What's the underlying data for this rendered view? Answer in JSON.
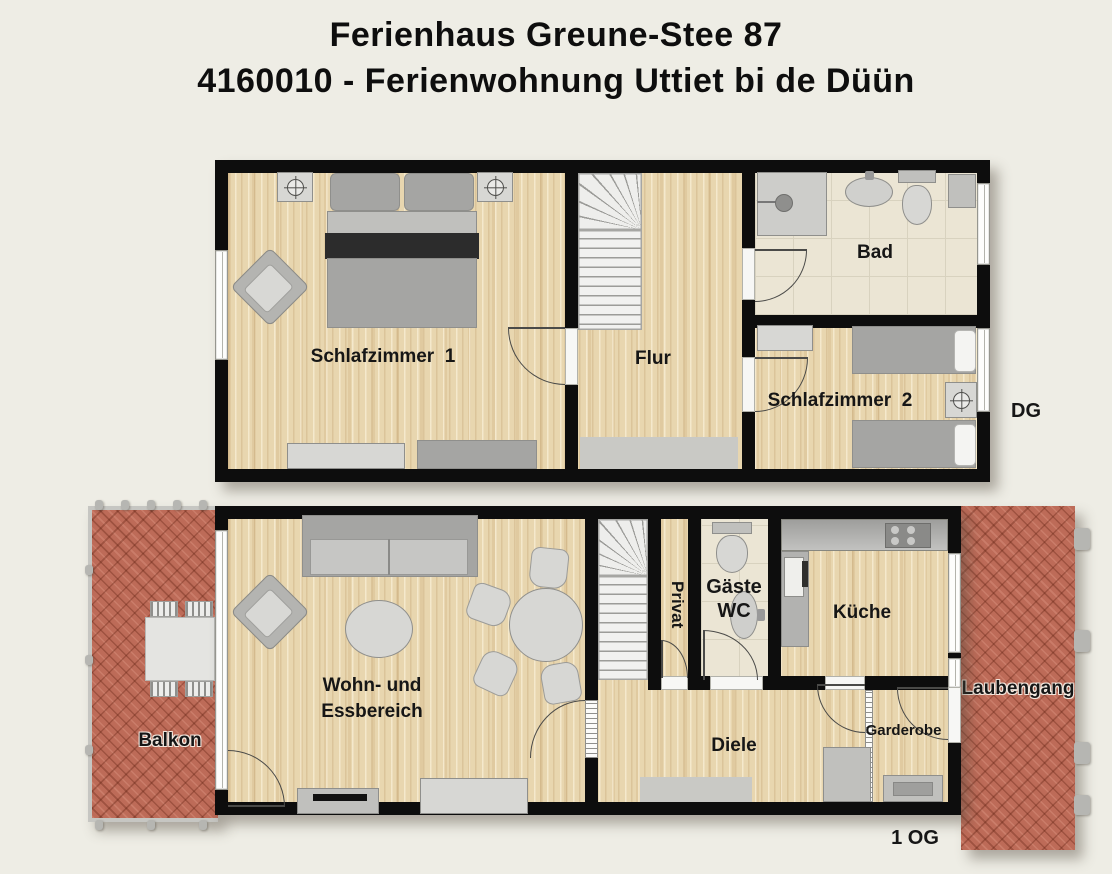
{
  "header": {
    "line1": "Ferienhaus Greune-Stee 87",
    "line2": "4160010 - Ferienwohnung Uttiet bi de Düün"
  },
  "floors": {
    "dg": {
      "tag": "DG",
      "rooms": {
        "schlafzimmer1": "Schlafzimmer  1",
        "flur": "Flur",
        "bad": "Bad",
        "schlafzimmer2": "Schlafzimmer  2"
      }
    },
    "og": {
      "tag": "1 OG",
      "rooms": {
        "balkon": "Balkon",
        "wohn_line1": "Wohn- und",
        "wohn_line2": "Essbereich",
        "privat": "Privat",
        "gaeste_line1": "Gäste",
        "gaeste_line2": "WC",
        "kueche": "Küche",
        "diele": "Diele",
        "garderobe": "Garderobe",
        "laubengang": "Laubengang"
      }
    }
  },
  "colors": {
    "background": "#eeede5",
    "wall": "#0d0d0d",
    "wood_floor": "#e8d6af",
    "tile_floor": "#ebe5d4",
    "brick": "#bd6b58",
    "furniture_gray": "#c0c0bd",
    "text": "#161616"
  }
}
